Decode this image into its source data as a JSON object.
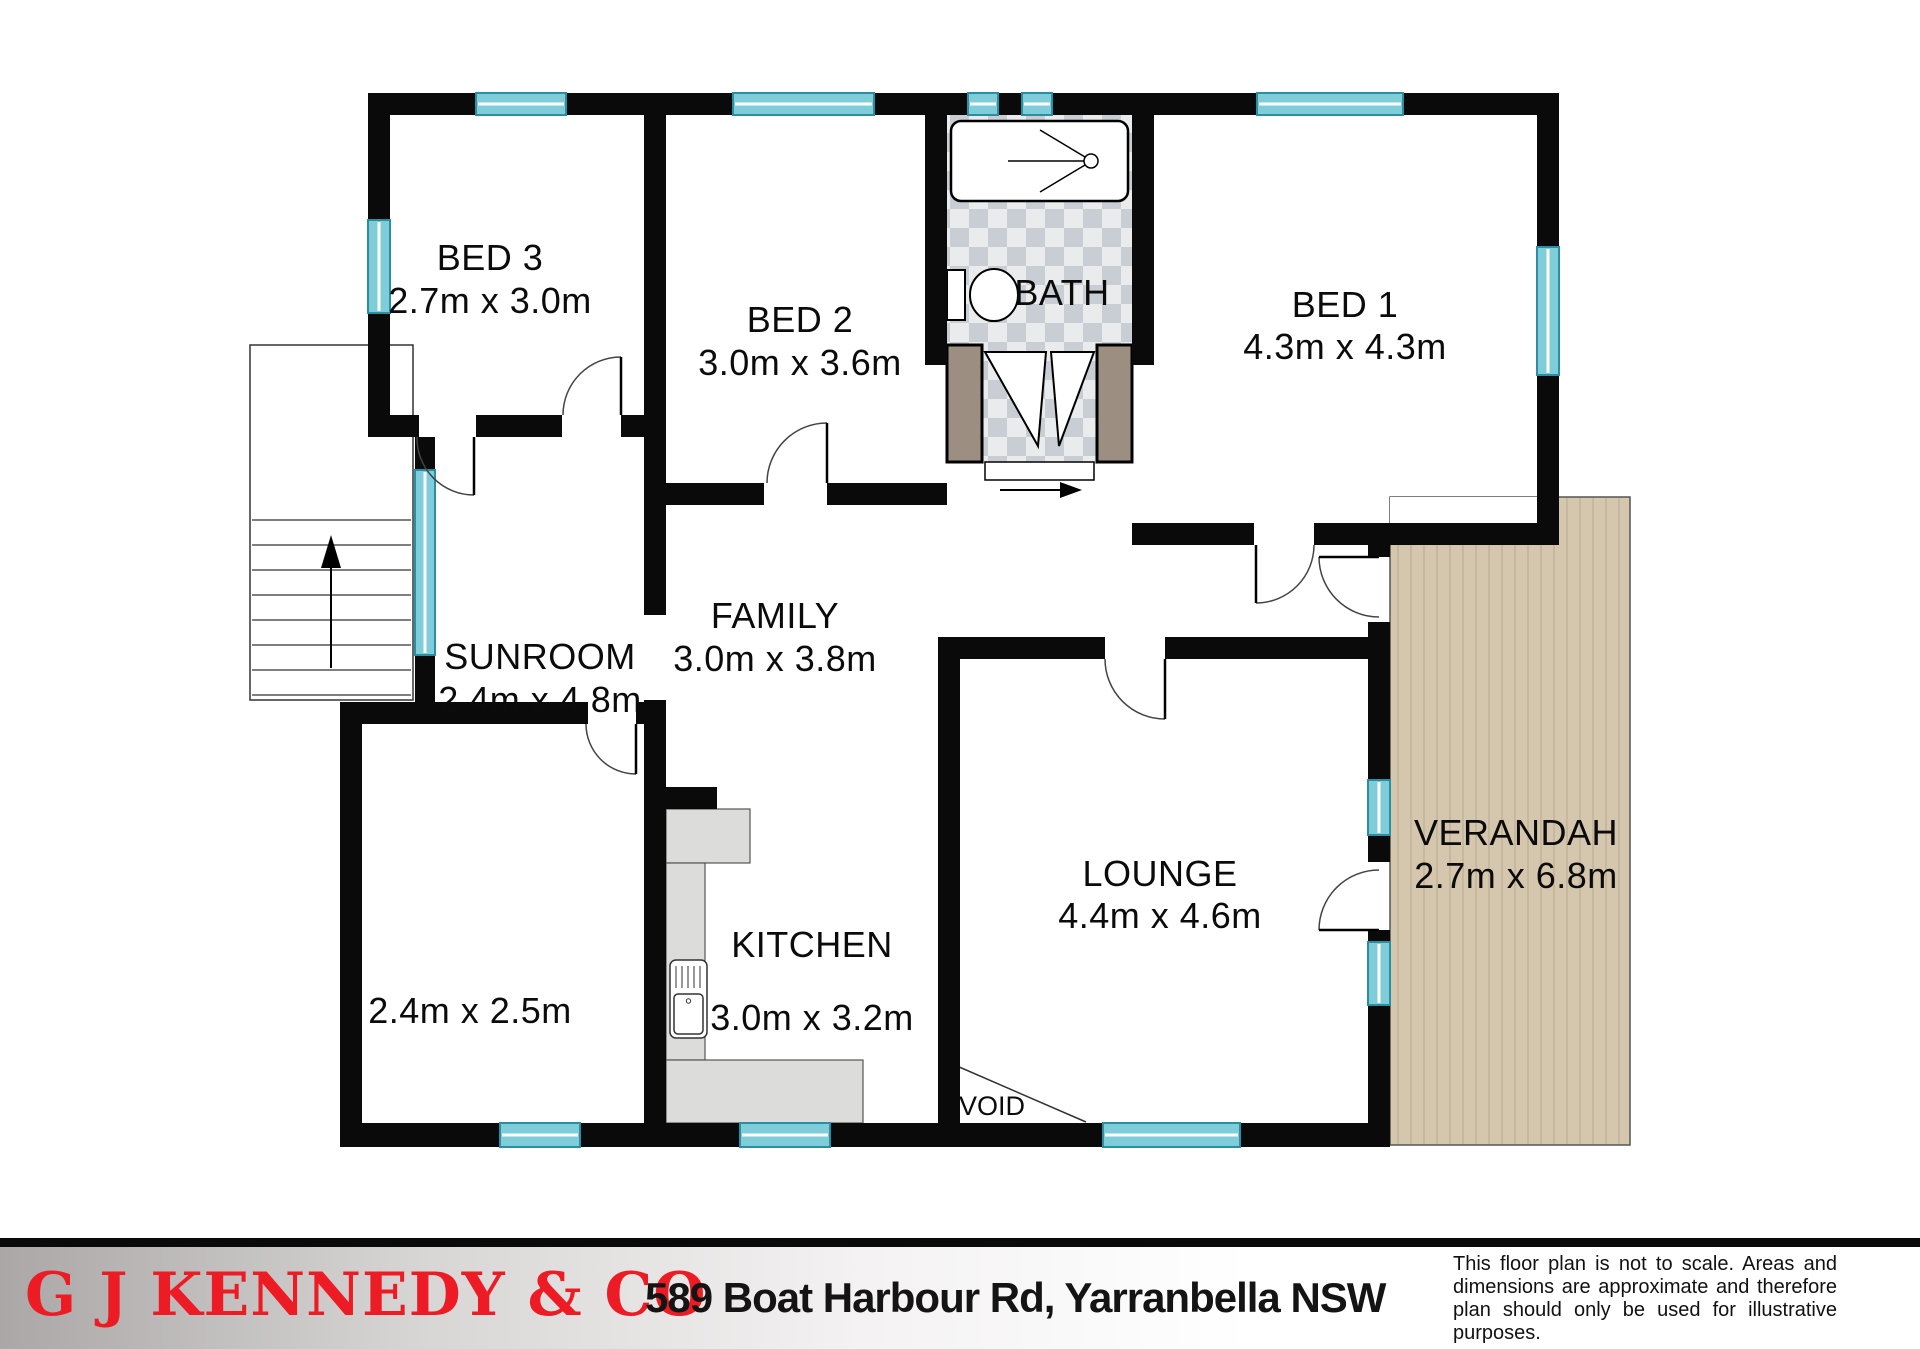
{
  "plan": {
    "rooms": [
      {
        "id": "bed3",
        "label": "BED 3",
        "dims": "2.7m x 3.0m"
      },
      {
        "id": "bed2",
        "label": "BED 2",
        "dims": "3.0m x 3.6m"
      },
      {
        "id": "bath",
        "label": "BATH",
        "dims": ""
      },
      {
        "id": "bed1",
        "label": "BED 1",
        "dims": "4.3m x 4.3m"
      },
      {
        "id": "sunroom",
        "label": "SUNROOM",
        "dims": "2.4m x 4.8m"
      },
      {
        "id": "family",
        "label": "FAMILY",
        "dims": "3.0m x 3.8m"
      },
      {
        "id": "kitchen",
        "label": "KITCHEN",
        "dims": "3.0m x 3.2m"
      },
      {
        "id": "lounge",
        "label": "LOUNGE",
        "dims": "4.4m x 4.6m"
      },
      {
        "id": "store",
        "label": "",
        "dims": "2.4m x 2.5m"
      },
      {
        "id": "verandah",
        "label": "VERANDAH",
        "dims": "2.7m x 6.8m"
      },
      {
        "id": "void",
        "label": "VOID",
        "dims": ""
      }
    ]
  },
  "footer": {
    "agency": "G J KENNEDY & CO",
    "address": "589 Boat Harbour Rd, Yarranbella NSW",
    "disclaimer": "This floor plan is not to scale. Areas and dimensions are approximate and therefore plan should only be used for illustrative purposes."
  },
  "colors": {
    "wall": "#0a0a0a",
    "window_fill": "#7ecdd9",
    "window_border": "#2a8fa3",
    "deck_fill": "#d4c7ad",
    "deck_stripe": "#b7aa8f",
    "robe_fill": "#9c8e80",
    "checker_a": "#c9ced4",
    "checker_b": "#e9ebed",
    "counter_fill": "#dcdcda",
    "logo_red": "#ed1c24"
  }
}
